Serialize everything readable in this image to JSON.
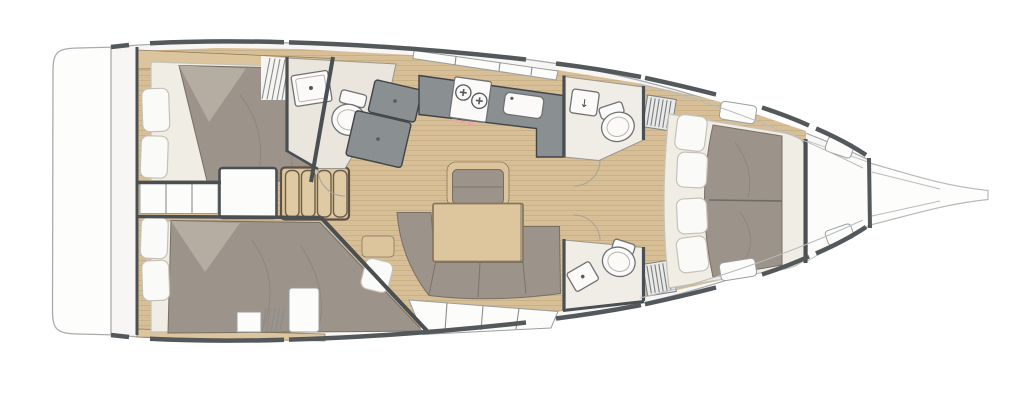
{
  "diagram": {
    "type": "yacht-floor-plan",
    "view": "top-down-deck-plan",
    "orientation": "bow-right-stern-left"
  },
  "labels": {
    "basin_arrow": "↓"
  },
  "colors": {
    "hullLine": "#a8acae",
    "sheer": "#53585b",
    "wall": "#4a4f52",
    "woodFloor": "#d8bf98",
    "plankLine": "#c3a87c",
    "woodFurniture": "#dcc49c",
    "woodTrim": "#8a7a5f",
    "upholstery": "#9c938a",
    "upholsteryEdge": "#776f66",
    "duvetFold": "#b6ada2",
    "mattress": "#f0ede5",
    "mattressEdge": "#c7c2b8",
    "counter": "#8a8f92",
    "counterEdge": "#3f4447",
    "headFloor": "#eae5dd",
    "white": "#fcfcfb",
    "pillow": "#fafaf8",
    "pillowEdge": "#c6c1b7",
    "accentPink": "#e8a9a2",
    "slat": "#7b7f82",
    "lockerFill": "#e9e9e7",
    "shelfLine": "#9a9e9f"
  },
  "features": [
    "hull",
    "transom-swim-platform",
    "bowsprit",
    "aft-cabin-port",
    "aft-cabin-starboard",
    "engine-compartment",
    "companionway-landing",
    "companionway-steps",
    "aft-head-toilet-and-washbasin",
    "nav-area-panels",
    "galley-counter",
    "galley-stove-two-burners",
    "galley-sink",
    "saloon-table",
    "saloon-chair",
    "saloon-sofa",
    "side-shelf",
    "forward-head-port",
    "forward-head-starboard",
    "louvered-lockers",
    "forward-cabin-island-berth",
    "forepeak-locker",
    "deck-hatches"
  ]
}
